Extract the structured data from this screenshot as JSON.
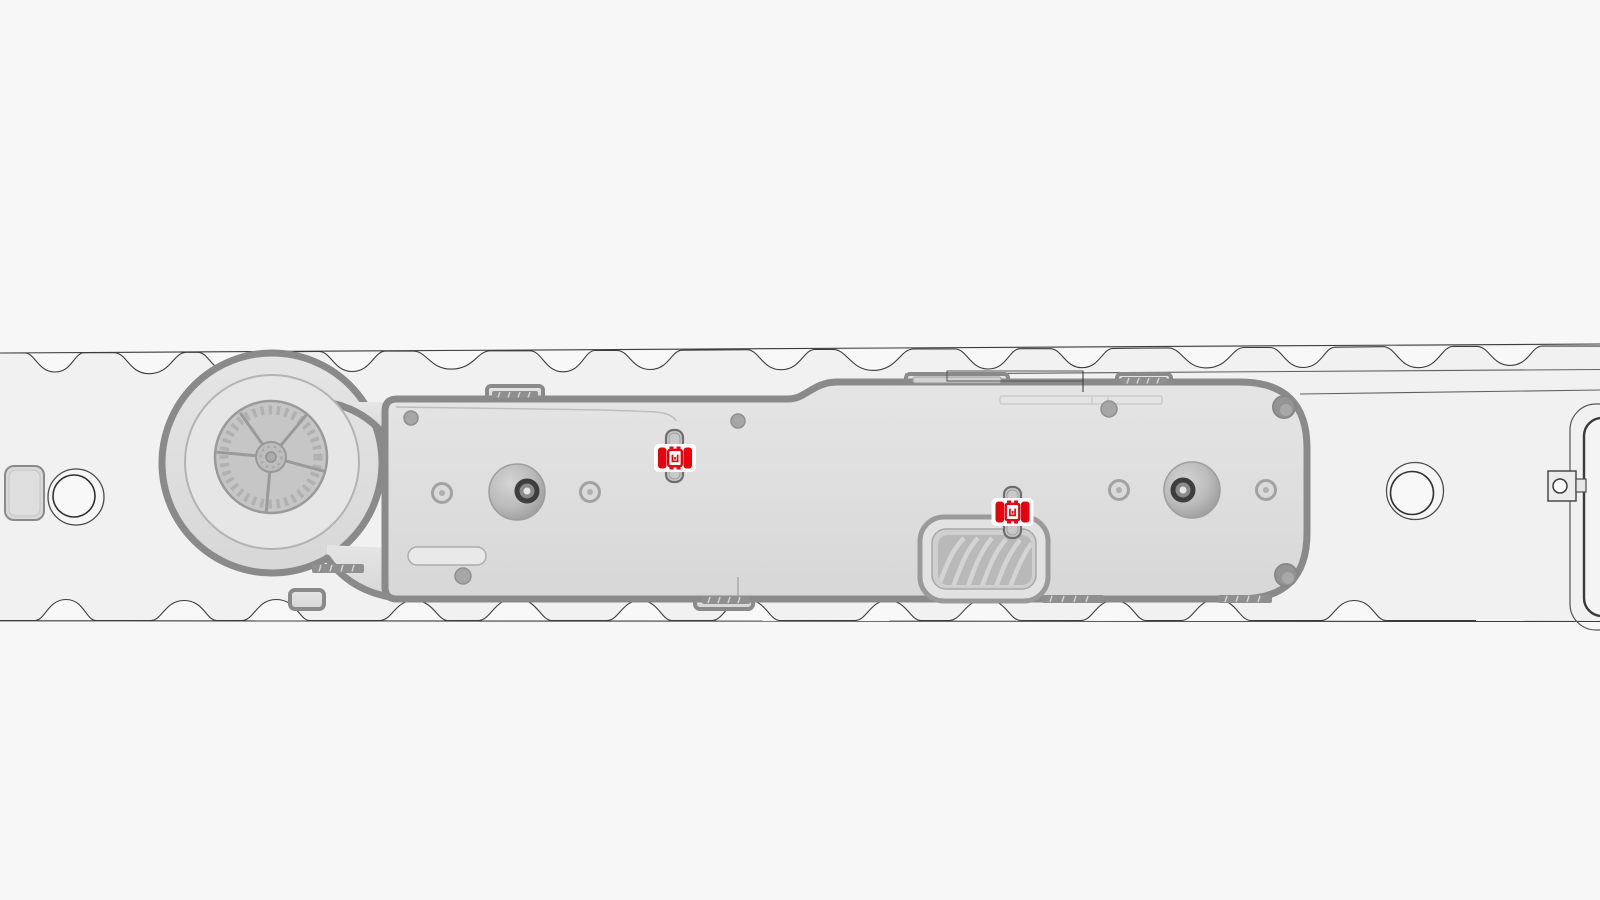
{
  "scene": {
    "markers": [
      {
        "id": "clip-marker-1",
        "transform": "translate(675,458)"
      },
      {
        "id": "clip-marker-2",
        "transform": "translate(1012.5,512)"
      }
    ]
  },
  "theme": {
    "page_bg": "#f7f7f7",
    "band_bg": "#f1f1f1",
    "band_light": "#f8f8f8",
    "line": "#3c3c3c",
    "module_stroke": "#8a8a8a",
    "part_mid": "#c6c6c6",
    "part_dark": "#9a9a9a",
    "rib_dark": "#8f8f8f",
    "rib_light": "#d6d6d6",
    "clip_fill": "#c9c9c9",
    "clip_stroke": "#6e6e6e",
    "red": "#e8000f",
    "white": "#ffffff"
  }
}
